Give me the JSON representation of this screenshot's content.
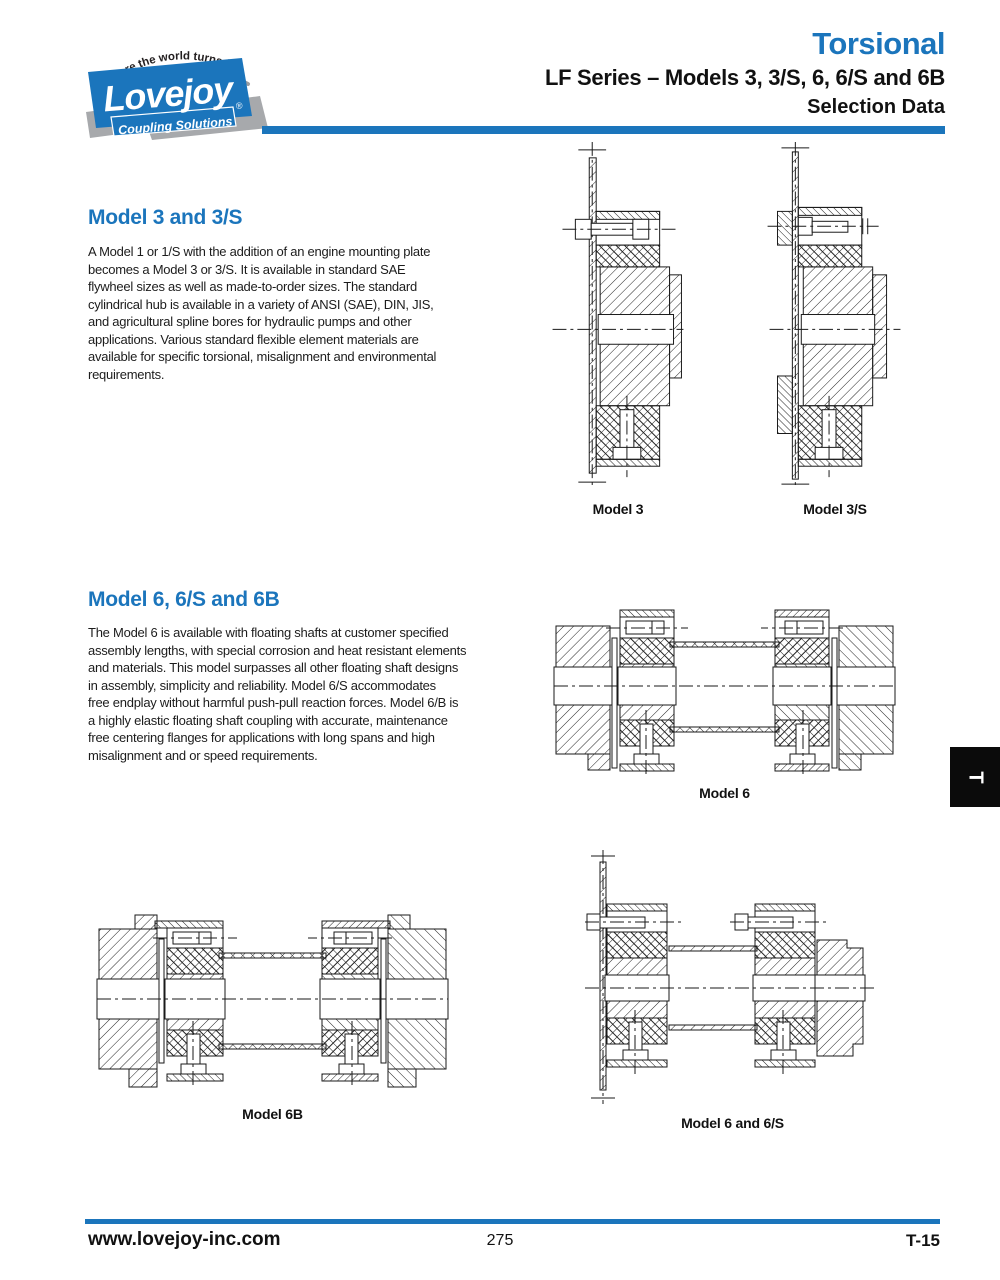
{
  "colors": {
    "accent_blue": "#1B75BC",
    "logo_gray": "#A7A9AC",
    "tab_black": "#0B0B0B"
  },
  "header": {
    "tagline": "where the world turns for",
    "brand": "Lovejoy",
    "brand_registered": "®",
    "brand_sub": "Coupling Solutions",
    "title": "Torsional",
    "subtitle": "LF Series – Models 3, 3/S, 6, 6/S and 6B",
    "subtitle2": "Selection Data"
  },
  "sections": [
    {
      "heading": "Model 3 and 3/S",
      "body_lines": [
        "A Model 1 or 1/S with the addition of an engine mounting plate",
        "becomes a Model 3 or 3/S. It is available in standard SAE",
        "flywheel sizes as well as made-to-order sizes. The standard",
        "cylindrical hub is available in a variety of ANSI (SAE), DIN, JIS,",
        "and agricultural spline bores for hydraulic pumps and other",
        "applications. Various standard flexible element materials are",
        "available for specific torsional, misalignment and environmental",
        "requirements."
      ]
    },
    {
      "heading": "Model 6, 6/S and 6B",
      "body_lines": [
        "The Model 6 is available with floating shafts at customer specified",
        "assembly lengths, with special corrosion and heat resistant elements",
        "and materials. This model surpasses all other floating shaft designs",
        "in assembly, simplicity and reliability. Model 6/S accommodates",
        "free endplay without harmful push-pull reaction forces. Model 6/B is",
        "a highly elastic floating shaft coupling with accurate, maintenance",
        "free centering flanges for applications with long spans and high",
        "misalignment and or speed requirements."
      ]
    }
  ],
  "figures": [
    {
      "label": "Model 3"
    },
    {
      "label": "Model 3/S"
    },
    {
      "label": "Model 6"
    },
    {
      "label": "Model 6B"
    },
    {
      "label": "Model 6 and 6/S"
    }
  ],
  "side_tab": {
    "label": "T"
  },
  "footer": {
    "website": "www.lovejoy-inc.com",
    "page_number": "275",
    "page_code": "T-15"
  }
}
